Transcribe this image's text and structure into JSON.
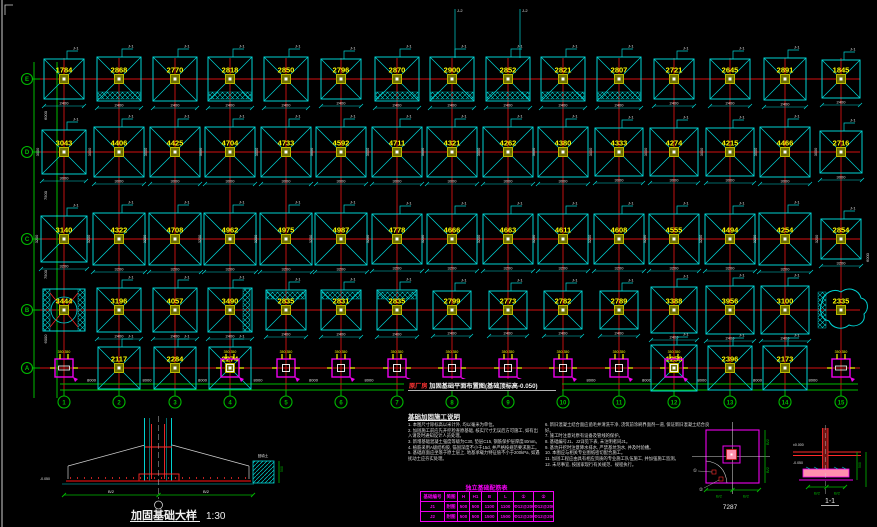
{
  "canvas": {
    "w": 877,
    "h": 527
  },
  "colors": {
    "cyan": "#00d2d2",
    "red": "#d41111",
    "red_bright": "#ff2a2a",
    "green": "#00bb00",
    "yellow": "#ffff00",
    "magenta": "#ee00ee",
    "white": "#e0e0e0",
    "olive": "#6e6e00",
    "olive_border": "#bcbc00",
    "pink": "#ff8fae"
  },
  "plan": {
    "col_x": [
      64,
      119,
      175,
      230,
      286,
      341,
      397,
      452,
      508,
      563,
      619,
      674,
      730,
      785,
      841
    ],
    "col_labels": [
      "1",
      "2",
      "3",
      "4",
      "5",
      "6",
      "7",
      "8",
      "9",
      "10",
      "11",
      "12",
      "13",
      "14",
      "15"
    ],
    "row_labels": [
      "E",
      "D",
      "C",
      "B",
      "A"
    ],
    "flag_label": "J-1",
    "anchor_dim": "350 350",
    "bay_dim": "8000",
    "left_dims": [
      "6000",
      "7500",
      "7500",
      "6000"
    ],
    "rows": [
      {
        "label": "E",
        "y": 79,
        "dim": "2400",
        "cells": [
          {
            "v": "1784",
            "s": 40
          },
          {
            "v": "2868",
            "s": 44,
            "h": "bottom"
          },
          {
            "v": "2770",
            "s": 44
          },
          {
            "v": "2818",
            "s": 44,
            "h": "bottom"
          },
          {
            "v": "2850",
            "s": 44
          },
          {
            "v": "2796",
            "s": 40
          },
          {
            "v": "2870",
            "s": 44,
            "h": "bottom"
          },
          {
            "v": "2900",
            "s": 44,
            "h": "bottom"
          },
          {
            "v": "2852",
            "s": 44,
            "h": "bottom"
          },
          {
            "v": "2821",
            "s": 44,
            "h": "bottom"
          },
          {
            "v": "2807",
            "s": 44,
            "h": "bottom"
          },
          {
            "v": "2721",
            "s": 40
          },
          {
            "v": "2645",
            "s": 40
          },
          {
            "v": "2891",
            "s": 42
          },
          {
            "v": "1845",
            "s": 38
          }
        ]
      },
      {
        "label": "D",
        "y": 152,
        "dim": "3000",
        "side_dim": "3000",
        "cells": [
          {
            "v": "3043",
            "s": 44
          },
          {
            "v": "4406",
            "s": 50
          },
          {
            "v": "4425",
            "s": 50
          },
          {
            "v": "4704",
            "s": 50
          },
          {
            "v": "4733",
            "s": 50
          },
          {
            "v": "4592",
            "s": 50
          },
          {
            "v": "4711",
            "s": 50
          },
          {
            "v": "4321",
            "s": 50
          },
          {
            "v": "4262",
            "s": 50
          },
          {
            "v": "4380",
            "s": 50
          },
          {
            "v": "4333",
            "s": 48
          },
          {
            "v": "4274",
            "s": 48
          },
          {
            "v": "4215",
            "s": 48
          },
          {
            "v": "4466",
            "s": 50
          },
          {
            "v": "2716",
            "s": 42
          }
        ]
      },
      {
        "label": "C",
        "y": 239,
        "dim": "3200",
        "side_dim": "3200",
        "cells": [
          {
            "v": "3140",
            "s": 46
          },
          {
            "v": "4322",
            "s": 52
          },
          {
            "v": "4708",
            "s": 52
          },
          {
            "v": "4962",
            "s": 52
          },
          {
            "v": "4975",
            "s": 52
          },
          {
            "v": "4987",
            "s": 52
          },
          {
            "v": "4778",
            "s": 50
          },
          {
            "v": "4666",
            "s": 50
          },
          {
            "v": "4663",
            "s": 50
          },
          {
            "v": "4611",
            "s": 50
          },
          {
            "v": "4608",
            "s": 50
          },
          {
            "v": "4555",
            "s": 50
          },
          {
            "v": "4494",
            "s": 50
          },
          {
            "v": "4254",
            "s": 52
          },
          {
            "v": "2854",
            "s": 40
          }
        ]
      },
      {
        "label": "B",
        "y": 310,
        "dim": "2400",
        "cells": [
          {
            "v": "3444",
            "s": 42,
            "sp": "hc"
          },
          {
            "v": "3196",
            "s": 44
          },
          {
            "v": "4057",
            "s": 44
          },
          {
            "v": "3490",
            "s": 44,
            "h": "right"
          },
          {
            "v": "2835",
            "s": 40,
            "h": "top"
          },
          {
            "v": "2831",
            "s": 40,
            "h": "top"
          },
          {
            "v": "2835",
            "s": 40,
            "h": "top"
          },
          {
            "v": "2799",
            "s": 38
          },
          {
            "v": "2773",
            "s": 38
          },
          {
            "v": "2782",
            "s": 38
          },
          {
            "v": "2789",
            "s": 38
          },
          {
            "v": "3388",
            "s": 46
          },
          {
            "v": "3956",
            "s": 48
          },
          {
            "v": "3100",
            "s": 48
          },
          {
            "v": "2335",
            "s": 38,
            "sp": "cloud"
          }
        ]
      },
      {
        "label": "A",
        "y": 368,
        "cells": [
          {
            "a": 1,
            "ab": "bar"
          },
          {
            "v": "2117",
            "s": 42
          },
          {
            "v": "2284",
            "s": 42
          },
          {
            "v": "2274",
            "s": 42,
            "a": 1
          },
          {
            "a": 1
          },
          {
            "a": 1
          },
          {
            "a": 1
          },
          {
            "a": 1
          },
          {
            "a": 1
          },
          {
            "a": 1
          },
          {
            "a": 1
          },
          {
            "v": "1258",
            "s": 46,
            "a": 1
          },
          {
            "v": "2396",
            "s": 44
          },
          {
            "v": "2173",
            "s": 44
          },
          {
            "a": 1,
            "ab": "bar"
          }
        ]
      }
    ]
  },
  "titles": {
    "plan_title_prefix": "原厂房",
    "plan_title": "加固基础平面布置图(基础顶标高-0.050)",
    "detail_caption": "加固基础大样",
    "detail_scale": "1:30",
    "detail_a_caption": "7287",
    "detail_b_caption": "1-1"
  },
  "notes": {
    "title": "基础加固施工说明",
    "left": [
      "1. 本图尺寸除标高以米计外, 均以毫米为单位。",
      "2. 加固施工前应先开挖检查原基础, 核实尺寸无误后方可施工, 如有出入请及时通知设计人员处理。",
      "3. 新增基础混凝土强度等级为C30, 垫层C15, 钢筋保护层厚度40mm。",
      "4. 植筋采用A级结构胶, 锚固深度不小于15d, 并严格按规范要求施工。",
      "5. 基础底面应坐落于原土层上, 地基承载力特征值不小于200kPa, 如遇扰动土应夯实处理。"
    ],
    "right": [
      "6. 新旧混凝土结合面应凿毛并清洗干净, 浇筑前涂刷界面剂一道, 保证新旧混凝土结合良好。",
      "7. 施工时注意对原有设备及管线的保护。",
      "8. 基础编号J1、J2详见下表, 未注明者同J1。",
      "9. 基坑开挖时注意降水排水, 严禁基坑泡水, 并及时验槽。",
      "10. 本图应与相关专业图纸密切配合施工。",
      "11. 加固工程应由具有相应资质的专业施工队伍施工, 并加强施工监测。",
      "12. 未尽事宜, 按国家现行有关规范、规程执行。"
    ]
  },
  "table": {
    "title": "独立基础配筋表",
    "headers": [
      "基础编号",
      "简图",
      "H",
      "H1",
      "B",
      "L",
      "①",
      "②"
    ],
    "rows": [
      [
        "J1",
        "附图",
        "500",
        "500",
        "1100",
        "1100",
        "Φ12@200",
        "Φ12@200"
      ],
      [
        "J2",
        "附图",
        "500",
        "500",
        "1500",
        "1500",
        "Φ12@200",
        "Φ12@200"
      ]
    ]
  },
  "detail_labels": {
    "dim_half": "B/2",
    "level_zero": "±0.000",
    "level_low": "-0.050",
    "side": "500",
    "fill": "回填土",
    "b1": "①",
    "b2": "②",
    "leader_label": "J-2"
  }
}
